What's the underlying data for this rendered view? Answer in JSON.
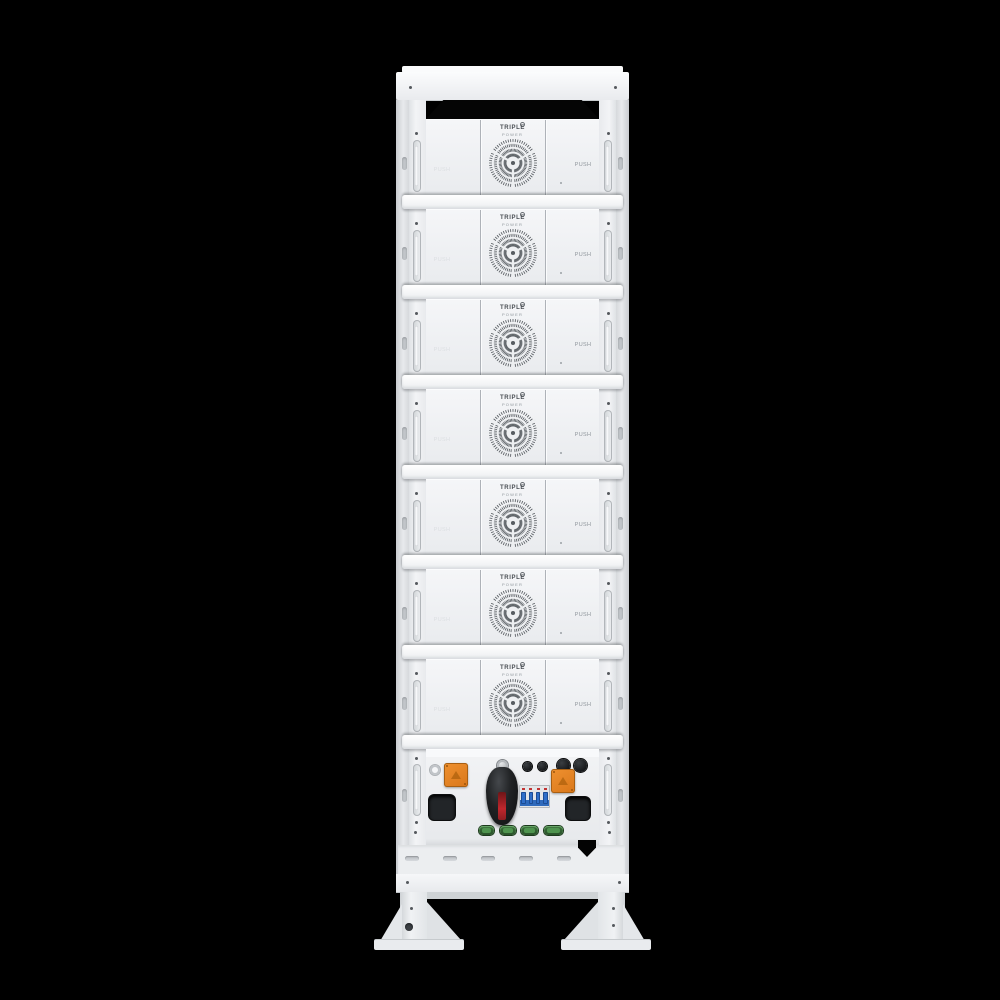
{
  "scene": {
    "description": "Front view of a white stacked battery energy-storage rack tower on a black background",
    "background_color": "#000000"
  },
  "module": {
    "logo_line1": "TRIPLE",
    "logo_line2": "POWER",
    "push_label": "PUSH"
  },
  "rack": {
    "module_count": 7,
    "vent_slot_count": 5,
    "comm_port_count": 4,
    "breaker_pole_count": 4
  },
  "colors": {
    "accent_orange": "#D9771A",
    "switch_red": "#C0272D",
    "breaker_blue": "#2F6FC9",
    "port_green": "#4F944F",
    "body_white": "#F1F3F4"
  }
}
